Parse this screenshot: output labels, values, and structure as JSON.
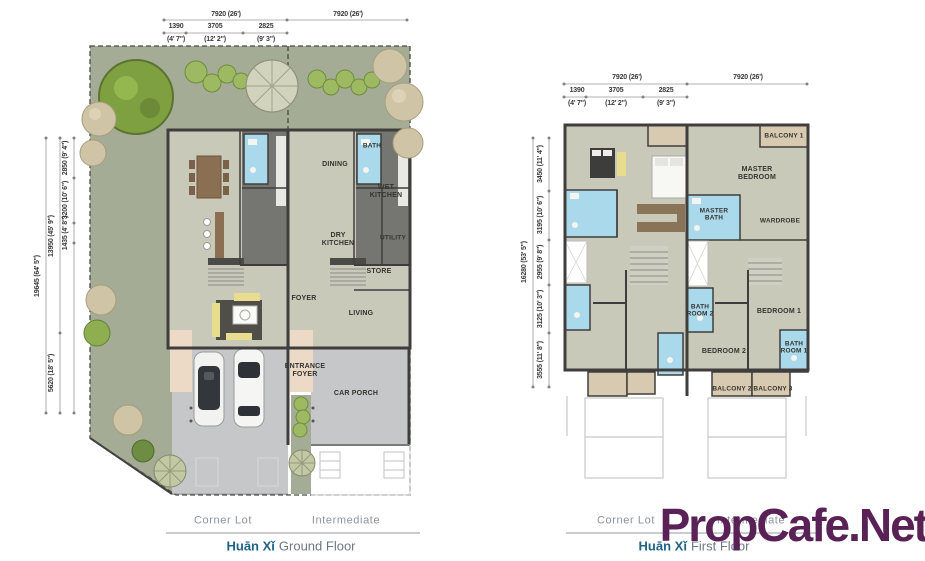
{
  "watermark": "PropCafe.Net",
  "colors": {
    "title_accent": "#1f6285",
    "caption": "#8d939c",
    "watermark": "#5a2156",
    "garden": "#a5ac96",
    "floor": "#c9c9ba",
    "bath_blue": "#aad9ec",
    "balcony_tan": "#d8cab0",
    "porch_gray": "#c6c7c9",
    "wall": "#3f3e3c"
  },
  "gf": {
    "dim_top_total_left": "7920 (26')",
    "dim_top_total_right": "7920 (26')",
    "dim_top_mm": [
      "1390",
      "3705",
      "2825"
    ],
    "dim_top_ft": [
      "(4' 7\")",
      "(12' 2\")",
      "(9' 3\")"
    ],
    "dim_left_total": "19645 (64' 5\")",
    "dim_left_mid": [
      "13950 (45' 9\")",
      "5620 (18' 5\")"
    ],
    "dim_left_segs": [
      "2850 (9' 4\")",
      "3200 (10' 6\")",
      "1435 (4' 8\")"
    ],
    "rooms": {
      "dining": "DINING",
      "bath": "BATH",
      "wet_kitchen": "WET KITCHEN",
      "dry_kitchen": "DRY KITCHEN",
      "utility": "UTILITY",
      "store": "STORE",
      "foyer": "FOYER",
      "living": "LIVING",
      "entrance_foyer": "ENTRANCE FOYER",
      "car_porch": "CAR PORCH"
    },
    "caption_left": "Corner Lot",
    "caption_right": "Intermediate",
    "title_name": "Huān Xǐ",
    "title_floor": "Ground Floor"
  },
  "ff": {
    "dim_top_total_left": "7920 (26')",
    "dim_top_total_right": "7920 (26')",
    "dim_top_mm": [
      "1390",
      "3705",
      "2825"
    ],
    "dim_top_ft": [
      "(4' 7\")",
      "(12' 2\")",
      "(9' 3\")"
    ],
    "dim_left_total": "16280 (53' 5\")",
    "dim_left_segs": [
      "3450 (11' 4\")",
      "3195 (10' 6\")",
      "2955 (9' 8\")",
      "3125 (10' 3\")",
      "3555 (11' 8\")"
    ],
    "rooms": {
      "balcony_1": "BALCONY 1",
      "master_bedroom": "MASTER BEDROOM",
      "master_bath": "MASTER BATH",
      "wardrobe": "WARDROBE",
      "bath_room_2": "BATH ROOM 2",
      "bedroom_2": "BEDROOM 2",
      "bedroom_1": "BEDROOM 1",
      "bath_room_1": "BATH ROOM 1",
      "balcony_2": "BALCONY 2",
      "balcony_3": "BALCONY 3"
    },
    "caption_left": "Corner Lot",
    "caption_right": "Intermediate",
    "title_name": "Huān Xǐ",
    "title_floor": "First Floor"
  }
}
